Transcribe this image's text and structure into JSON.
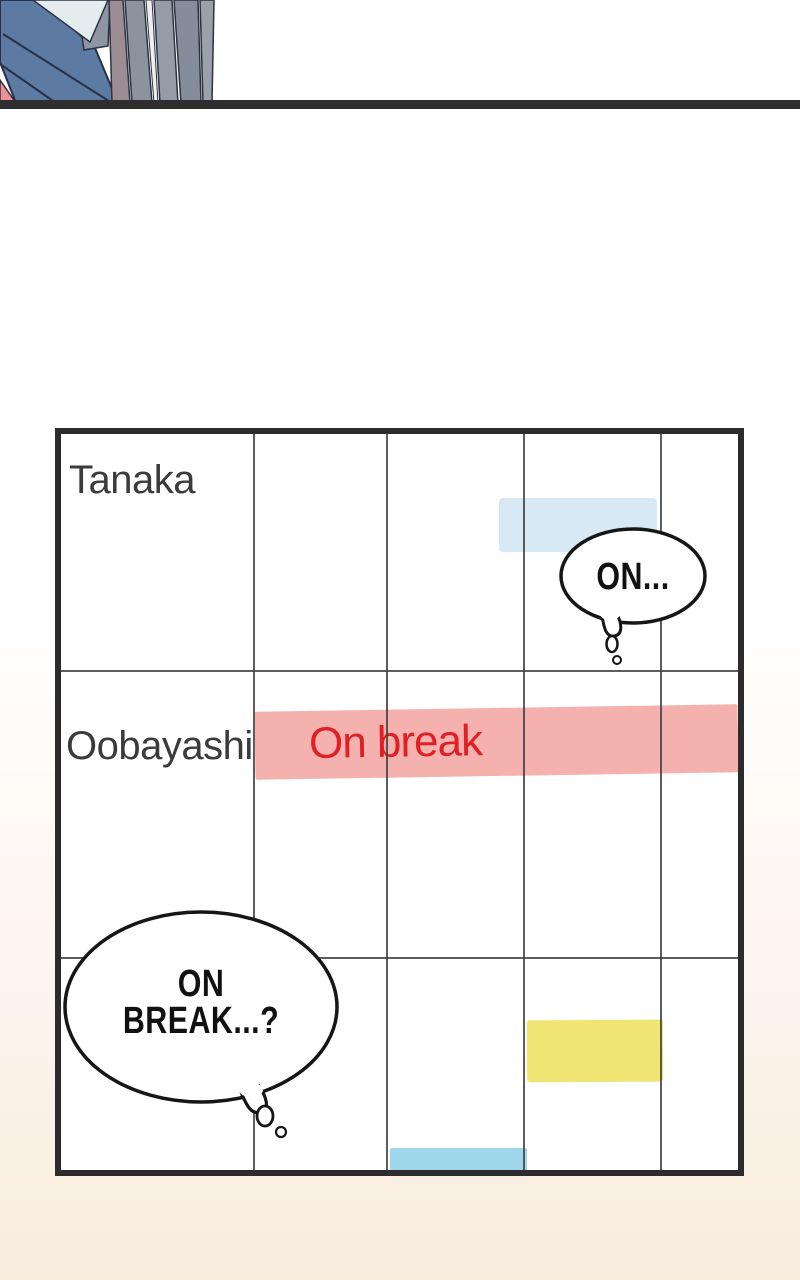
{
  "panel": {
    "artwork": "character-closeup-hair-and-clothes",
    "artwork_colors": {
      "clothing_blue": "#5d7ba2",
      "highlight_pale": "#e4ecee",
      "facet_gray": "#8e96a3",
      "hair_mauve": "#9c8c93",
      "hair_gray": "#8c929e",
      "hair_gray_light": "#959ba7",
      "hair_gray_dark": "#868d9a",
      "accent_pink": "#ee9095",
      "outline": "#2b3242",
      "divider_black": "#2e2e2e"
    }
  },
  "schedule": {
    "rows": [
      {
        "name": "Tanaka",
        "bars": [
          {
            "label": "",
            "color": "#d7e9f4"
          }
        ]
      },
      {
        "name": "Oobayashi",
        "bars": [
          {
            "label": "On break",
            "color": "#f5b1ad",
            "label_color": "#e01f26"
          }
        ]
      },
      {
        "name": "",
        "bars": [
          {
            "label": "",
            "color": "#efe573"
          },
          {
            "label": "",
            "color": "#9fd6eb"
          }
        ]
      }
    ]
  },
  "bubbles": [
    {
      "text": "ON..."
    },
    {
      "line1": "ON",
      "line2": "BREAK...?"
    }
  ],
  "colors": {
    "table_border": "#2c2c2c",
    "grid_line": "#414141",
    "name_text": "#3b3b3b",
    "bubble_outline": "#161616",
    "background_bottom": "#f8ecdd"
  }
}
